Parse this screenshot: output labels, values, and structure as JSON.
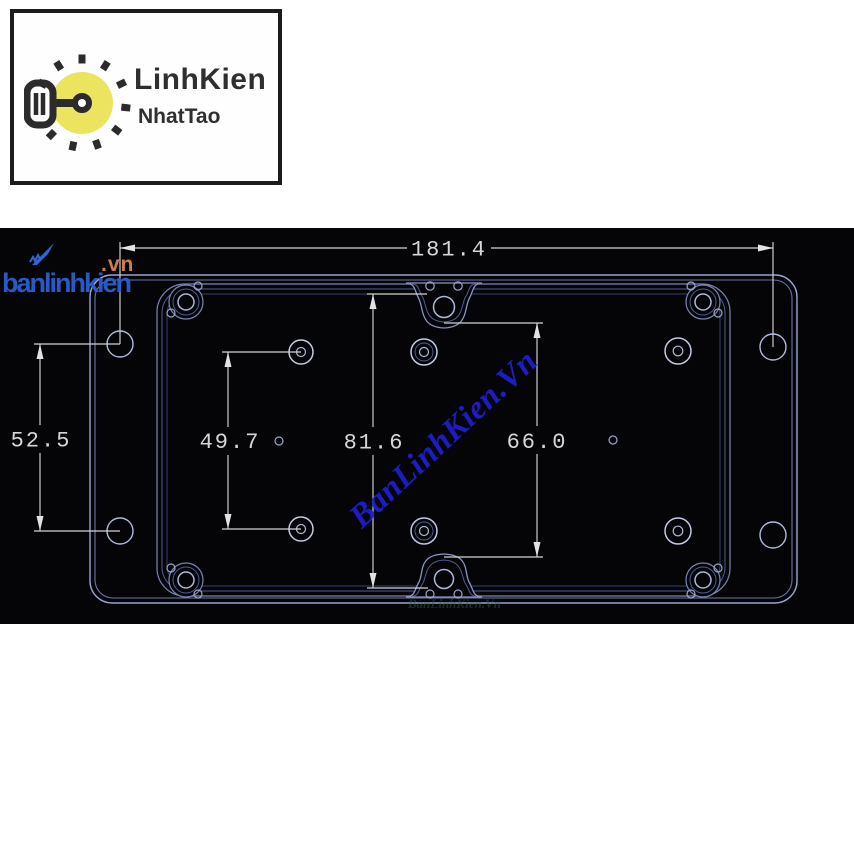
{
  "brand_card": {
    "name": "LinhKien",
    "subname": "NhatTao",
    "icon": "lightbulb-key-icon"
  },
  "watermarks": {
    "corner_icon": "swoosh-icon",
    "corner_text": "banlinhkien",
    "corner_suffix": ".vn",
    "diagonal": "BanLinhKien.Vn"
  },
  "drawing": {
    "type": "technical-drawing",
    "dimensions": [
      {
        "id": "overall-width",
        "value": "181.4"
      },
      {
        "id": "left-mounting-hole-spacing",
        "value": "52.5"
      },
      {
        "id": "boss-column-spacing",
        "value": "49.7"
      },
      {
        "id": "center-tab-span",
        "value": "81.6"
      },
      {
        "id": "right-tab-span",
        "value": "66.0"
      }
    ],
    "colors": {
      "background": "#050508",
      "outline": "#9aa4d0",
      "outline_dim": "#525c92",
      "dimension": "#d6d6d6",
      "watermark_diagonal_blue": "#1f1fd4",
      "watermark_corner_blue": "#2a5ed2",
      "watermark_orange": "#cd7f47",
      "logo_yellow": "#ece45e",
      "logo_dark": "#2b2b2b"
    }
  }
}
